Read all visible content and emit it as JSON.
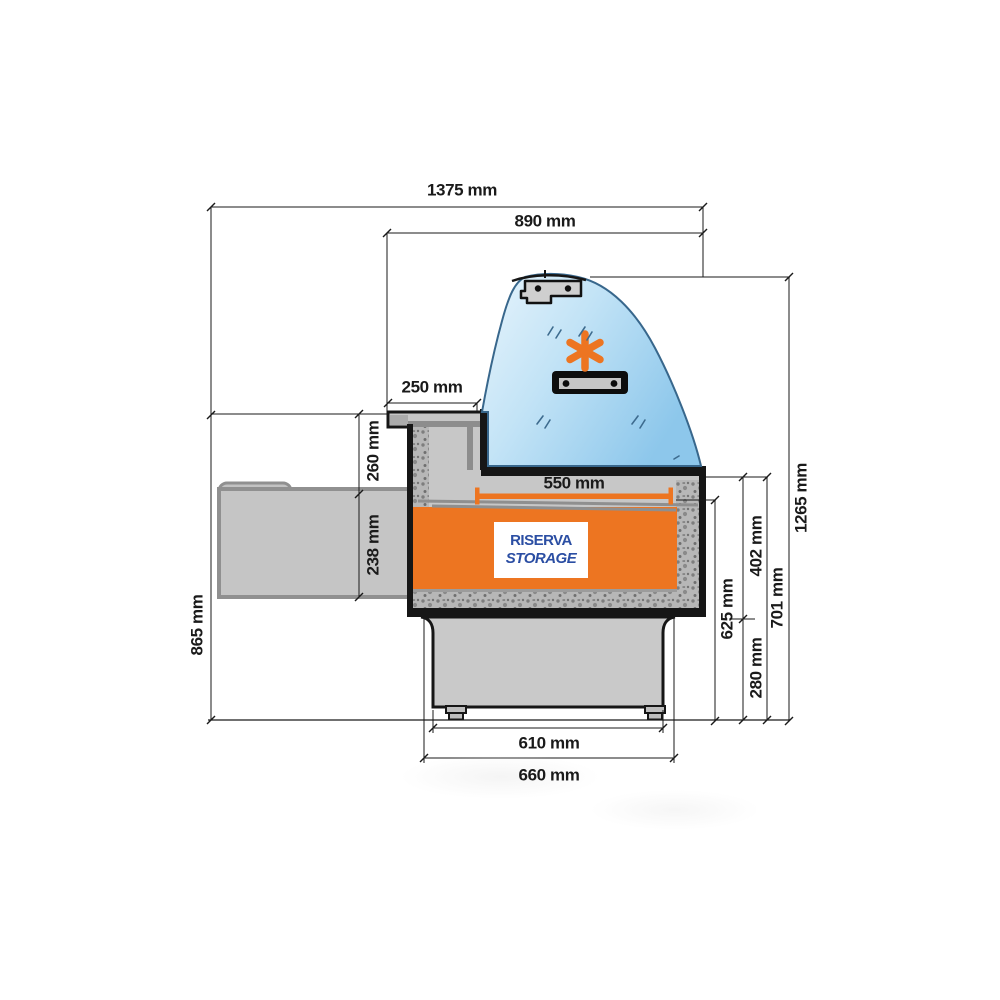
{
  "drawing": {
    "description": "Side cross-section technical drawing of a refrigerated serve-over display counter",
    "storage_label_line1": "RISERVA",
    "storage_label_line2": "STORAGE"
  },
  "dimensions": {
    "total_depth": "1375 mm",
    "case_depth": "890 mm",
    "top_ledge_depth": "250 mm",
    "display_well_depth": "550 mm",
    "worktop_height": "865 mm",
    "upper_section_height": "260 mm",
    "shelf_section_height": "238 mm",
    "well_floor_height": "625 mm",
    "case_body_height": "402 mm",
    "base_section_height": "280 mm",
    "counter_front_height": "701 mm",
    "overall_height": "1265 mm",
    "base_inner_width": "610 mm",
    "base_outer_width": "660 mm"
  },
  "colors": {
    "accent_orange": "#ED7521",
    "brand_blue": "#2B4EA3",
    "glass_blue": "#A9D6F0",
    "body_gray": "#C7C7C7",
    "line_black": "#1A1A1A"
  },
  "icons": {
    "snowflake": "refrigeration-symbol",
    "lamp": "light-fixture",
    "hinge": "canopy-hinge-bracket"
  }
}
